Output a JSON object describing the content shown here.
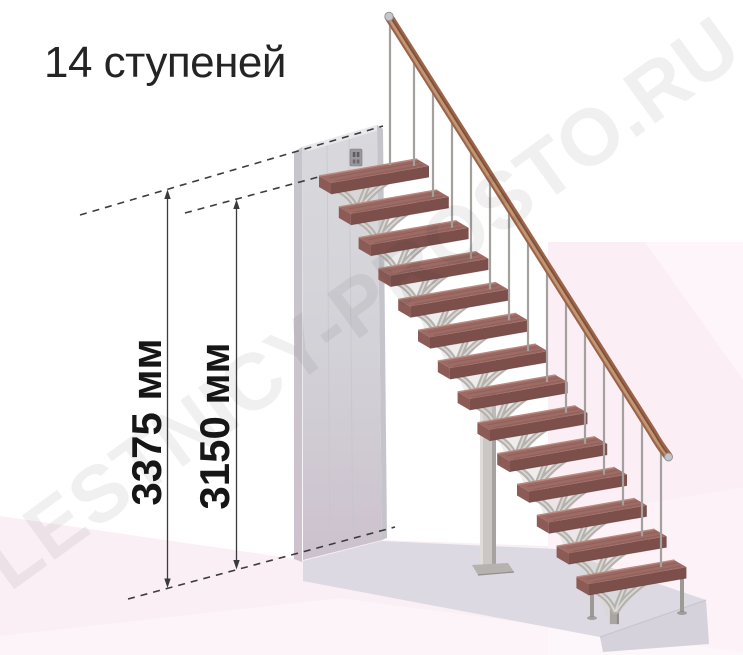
{
  "title": "14 ступеней",
  "watermark": "LESTNICY-PROSTO.RU",
  "diagram": {
    "type": "staircase-side-elevation",
    "steps_count": 14,
    "dimensions": [
      {
        "label": "3375 мм",
        "value_mm": 3375
      },
      {
        "label": "3150 мм",
        "value_mm": 3150
      }
    ]
  },
  "colors": {
    "tread_top": "#9d6b64",
    "tread_front": "#7c4f4b",
    "handrail": "#9c654a",
    "metal_frame": "#b5b1ad",
    "wall_gray": "#d6d4da",
    "platform_gray": "#dcd9e2",
    "floor_pink": "#faeff5",
    "backdrop_pink": "#fbeff5",
    "dimension_line": "#3a3a3a",
    "title_text": "#242424"
  }
}
